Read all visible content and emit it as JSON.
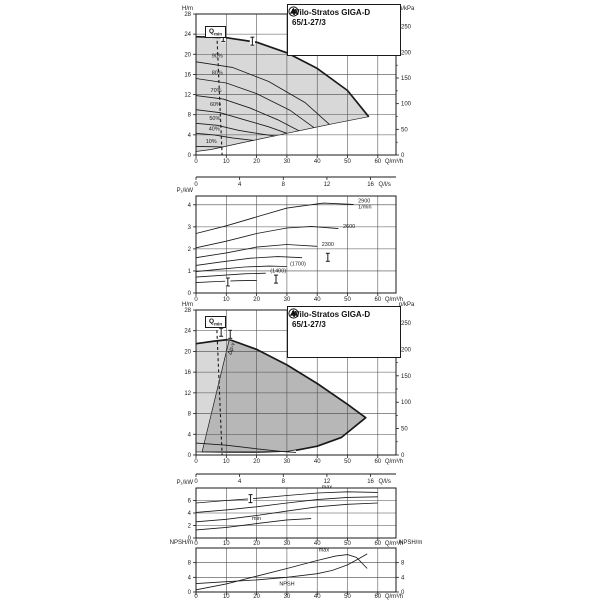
{
  "title_box": {
    "line1": "Wilo-Stratos GIGA-D",
    "line2": "65/1-27/3"
  },
  "qmin": {
    "main": "Q",
    "sub": "min"
  },
  "chart_data": [
    {
      "id": "c1",
      "type": "area",
      "title": "Wilo-Stratos GIGA-D 65/1-27/3 pump curves (speed control range)",
      "x_axis": {
        "label": "Q/m³/h",
        "min": 0,
        "max": 66,
        "ticks": [
          0,
          10,
          20,
          30,
          40,
          50,
          60
        ]
      },
      "x_axis2": {
        "label": "Q/l/s",
        "ticks": [
          0,
          4,
          8,
          12,
          16
        ],
        "factor": 3.6
      },
      "y_axis": {
        "label": "H/m",
        "min": 0,
        "max": 28,
        "ticks": [
          0,
          4,
          8,
          12,
          16,
          20,
          24,
          28
        ]
      },
      "y_axis_right": {
        "label": "p/kPa",
        "ticks": [
          0,
          50,
          100,
          150,
          200,
          250
        ],
        "per_m": 9.81
      },
      "regions": [
        {
          "name": "duty-range",
          "fill": "#d8d8d8",
          "pts": [
            [
              0,
              23.5
            ],
            [
              10,
              23.3
            ],
            [
              20,
              22.4
            ],
            [
              30,
              20.3
            ],
            [
              40,
              17.2
            ],
            [
              50,
              12.8
            ],
            [
              57,
              7.6
            ],
            [
              45,
              6.2
            ],
            [
              30,
              4.3
            ],
            [
              15,
              2.4
            ],
            [
              5,
              1.1
            ],
            [
              0,
              0.7
            ]
          ]
        }
      ],
      "edges": [
        {
          "name": "max-speed-curve",
          "pts": [
            [
              0,
              23.5
            ],
            [
              10,
              23.3
            ],
            [
              20,
              22.4
            ],
            [
              30,
              20.3
            ],
            [
              40,
              17.2
            ],
            [
              50,
              12.8
            ],
            [
              57,
              7.6
            ]
          ]
        }
      ],
      "curves": [
        {
          "label": "90%",
          "lx": 5.2,
          "ly": 19.4,
          "pts": [
            [
              0,
              18.5
            ],
            [
              12,
              17.4
            ],
            [
              24,
              14.6
            ],
            [
              36,
              10.4
            ],
            [
              44,
              6.1
            ]
          ]
        },
        {
          "label": "80%",
          "lx": 5.2,
          "ly": 16.0,
          "pts": [
            [
              0,
              15.2
            ],
            [
              10,
              14.3
            ],
            [
              20,
              12.2
            ],
            [
              31,
              8.9
            ],
            [
              39,
              5.4
            ]
          ]
        },
        {
          "label": "70%",
          "lx": 4.8,
          "ly": 12.5,
          "pts": [
            [
              0,
              11.8
            ],
            [
              9,
              11.1
            ],
            [
              18,
              9.3
            ],
            [
              27,
              7.0
            ],
            [
              34,
              4.8
            ]
          ]
        },
        {
          "label": "60%",
          "lx": 4.6,
          "ly": 9.7,
          "pts": [
            [
              0,
              9.0
            ],
            [
              8,
              8.4
            ],
            [
              16,
              7.0
            ],
            [
              24,
              5.6
            ],
            [
              30,
              4.3
            ]
          ]
        },
        {
          "label": "50%",
          "lx": 4.4,
          "ly": 7.0,
          "pts": [
            [
              0,
              6.3
            ],
            [
              7,
              5.9
            ],
            [
              14,
              4.9
            ],
            [
              21,
              4.2
            ],
            [
              26,
              3.8
            ]
          ]
        },
        {
          "label": "40%",
          "lx": 4.2,
          "ly": 4.9,
          "pts": [
            [
              0,
              4.3
            ],
            [
              6,
              4.0
            ],
            [
              12,
              3.4
            ],
            [
              19,
              2.9
            ]
          ]
        },
        {
          "label": "10%",
          "lx": 3.2,
          "ly": 2.4,
          "pts": [
            [
              0,
              1.7
            ],
            [
              5,
              1.65
            ],
            [
              9,
              1.6
            ]
          ]
        }
      ],
      "dashed": [
        {
          "name": "qmin-line",
          "pts": [
            [
              6.9,
              23.8
            ],
            [
              8.6,
              0
            ]
          ]
        }
      ],
      "markers": [
        [
          9,
          23.35
        ],
        [
          18.6,
          22.6
        ]
      ],
      "labels": []
    },
    {
      "id": "c2",
      "type": "line",
      "title": "Power input P1 vs Q at constant speeds",
      "x_axis": {
        "label": "Q/m³/h",
        "min": 0,
        "max": 66,
        "ticks": [
          0,
          10,
          20,
          30,
          40,
          50,
          60
        ]
      },
      "y_axis": {
        "label": "P₁/kW",
        "min": 0,
        "max": 4.4,
        "ticks": [
          0,
          1,
          2,
          3,
          4
        ]
      },
      "regions": [],
      "edges": [],
      "curves": [
        {
          "label": "2900",
          "label2": "1/min",
          "lx": 53.5,
          "ly": 4.1,
          "pts": [
            [
              0,
              2.7
            ],
            [
              10,
              3.05
            ],
            [
              20,
              3.45
            ],
            [
              30,
              3.85
            ],
            [
              42,
              4.08
            ],
            [
              52,
              4.02
            ]
          ]
        },
        {
          "label": "2600",
          "lx": 48.5,
          "ly": 2.95,
          "pts": [
            [
              0,
              2.05
            ],
            [
              10,
              2.35
            ],
            [
              20,
              2.7
            ],
            [
              30,
              2.95
            ],
            [
              38,
              3.02
            ],
            [
              47,
              2.92
            ]
          ]
        },
        {
          "label": "2300",
          "lx": 41.5,
          "ly": 2.14,
          "pts": [
            [
              0,
              1.6
            ],
            [
              10,
              1.82
            ],
            [
              20,
              2.08
            ],
            [
              30,
              2.2
            ],
            [
              40,
              2.12
            ]
          ]
        },
        {
          "label": "",
          "pts": [
            [
              0,
              1.25
            ],
            [
              8,
              1.4
            ],
            [
              18,
              1.58
            ],
            [
              27,
              1.65
            ],
            [
              35,
              1.6
            ]
          ]
        },
        {
          "label": "(1700)",
          "lx": 31,
          "ly": 1.24,
          "pts": [
            [
              0,
              0.97
            ],
            [
              8,
              1.08
            ],
            [
              16,
              1.18
            ],
            [
              24,
              1.22
            ],
            [
              30,
              1.2
            ]
          ]
        },
        {
          "label": "(1400)",
          "lx": 24.5,
          "ly": 0.93,
          "pts": [
            [
              0,
              0.72
            ],
            [
              8,
              0.8
            ],
            [
              16,
              0.87
            ],
            [
              23,
              0.9
            ]
          ]
        },
        {
          "label": "",
          "pts": [
            [
              0,
              0.47
            ],
            [
              7,
              0.52
            ],
            [
              14,
              0.56
            ],
            [
              20,
              0.57
            ]
          ]
        }
      ],
      "dashed": [],
      "markers": [
        [
          43.5,
          1.62
        ],
        [
          26.4,
          0.63
        ],
        [
          10.5,
          0.5
        ]
      ],
      "labels": []
    },
    {
      "id": "c3",
      "type": "area",
      "title": "Wilo-Stratos GIGA-D 65/1-27/3 control range Δp-v",
      "x_axis": {
        "label": "Q/m³/h",
        "min": 0,
        "max": 66,
        "ticks": [
          0,
          10,
          20,
          30,
          40,
          50,
          60
        ]
      },
      "x_axis2": {
        "label": "Q/l/s",
        "ticks": [
          0,
          4,
          8,
          12,
          16
        ],
        "factor": 3.6
      },
      "y_axis": {
        "label": "H/m",
        "min": 0,
        "max": 28,
        "ticks": [
          0,
          4,
          8,
          12,
          16,
          20,
          24,
          28
        ]
      },
      "y_axis_right": {
        "label": "p/kPa",
        "ticks": [
          0,
          50,
          100,
          150,
          200,
          250
        ],
        "per_m": 9.81
      },
      "regions": [
        {
          "name": "full-duty-range",
          "fill": "#d8d8d8",
          "pts": [
            [
              0,
              21.5
            ],
            [
              6,
              22.0
            ],
            [
              11,
              22.3
            ],
            [
              20,
              20.4
            ],
            [
              30,
              17.4
            ],
            [
              40,
              13.8
            ],
            [
              50,
              9.8
            ],
            [
              56,
              7.2
            ],
            [
              48,
              3.4
            ],
            [
              40,
              1.7
            ],
            [
              30,
              0.7
            ],
            [
              20,
              0.45
            ],
            [
              10,
              0.5
            ],
            [
              0,
              0.6
            ]
          ]
        },
        {
          "name": "dp-v-control-range",
          "fill": "#b7b7b7",
          "pts": [
            [
              2,
              0.6
            ],
            [
              11,
              22.3
            ],
            [
              20,
              20.4
            ],
            [
              30,
              17.4
            ],
            [
              40,
              13.8
            ],
            [
              50,
              9.8
            ],
            [
              56,
              7.2
            ],
            [
              48,
              3.4
            ],
            [
              40,
              1.7
            ],
            [
              30,
              0.7
            ],
            [
              20,
              0.6
            ],
            [
              10,
              0.6
            ]
          ]
        }
      ],
      "edges": [
        {
          "name": "max-speed-curve",
          "pts": [
            [
              0,
              21.5
            ],
            [
              6,
              22.0
            ],
            [
              11,
              22.3
            ],
            [
              20,
              20.4
            ],
            [
              30,
              17.4
            ],
            [
              40,
              13.8
            ],
            [
              50,
              9.8
            ],
            [
              56,
              7.2
            ],
            [
              48,
              3.4
            ],
            [
              40,
              1.7
            ],
            [
              33,
              0.9
            ]
          ]
        }
      ],
      "curves": [
        {
          "label": "",
          "pts": [
            [
              0,
              2.3
            ],
            [
              10,
              1.9
            ],
            [
              20,
              1.2
            ],
            [
              28,
              0.7
            ],
            [
              33,
              0.5
            ]
          ]
        }
      ],
      "dashed": [
        {
          "name": "qmin-line",
          "pts": [
            [
              6.9,
              24.1
            ],
            [
              8.6,
              0
            ]
          ]
        }
      ],
      "markers": [
        [
          8.3,
          23.7
        ],
        [
          11.3,
          23.3
        ]
      ],
      "labels": [
        {
          "text": "Δp-v",
          "q": 11.6,
          "v": 19.3,
          "rot": -72
        }
      ]
    },
    {
      "id": "c4",
      "type": "line",
      "title": "Power input P1 control range min/max",
      "x_axis": {
        "label": "Q/m³/h",
        "min": 0,
        "max": 66,
        "ticks": [
          0,
          10,
          20,
          30,
          40,
          50,
          60
        ]
      },
      "y_axis": {
        "label": "P₁/kW",
        "min": 0,
        "max": 8,
        "ticks": [
          0,
          2,
          4,
          6
        ]
      },
      "regions": [],
      "edges": [],
      "curves": [
        {
          "label": "max",
          "lx": 41.5,
          "ly": 7.9,
          "pts": [
            [
              0,
              5.6
            ],
            [
              10,
              6.0
            ],
            [
              20,
              6.35
            ],
            [
              30,
              6.8
            ],
            [
              40,
              7.2
            ],
            [
              50,
              7.4
            ],
            [
              60,
              7.3
            ]
          ]
        },
        {
          "label": "",
          "pts": [
            [
              0,
              4.1
            ],
            [
              10,
              4.5
            ],
            [
              20,
              5.0
            ],
            [
              30,
              5.6
            ],
            [
              40,
              6.15
            ],
            [
              50,
              6.5
            ],
            [
              60,
              6.6
            ]
          ]
        },
        {
          "label": "",
          "pts": [
            [
              0,
              2.6
            ],
            [
              10,
              3.0
            ],
            [
              20,
              3.6
            ],
            [
              30,
              4.3
            ],
            [
              40,
              5.0
            ],
            [
              50,
              5.4
            ],
            [
              60,
              5.6
            ]
          ]
        },
        {
          "label": "min",
          "lx": 18.5,
          "ly": 2.9,
          "pts": [
            [
              0,
              1.3
            ],
            [
              10,
              1.7
            ],
            [
              20,
              2.3
            ],
            [
              30,
              2.9
            ],
            [
              38,
              3.1
            ]
          ]
        }
      ],
      "dashed": [],
      "markers": [
        [
          18,
          6.3
        ]
      ],
      "labels": []
    },
    {
      "id": "c5",
      "type": "line",
      "title": "NPSH vs Q",
      "x_axis": {
        "label": "Q/m³/h",
        "min": 0,
        "max": 66,
        "ticks": [
          0,
          10,
          20,
          30,
          40,
          50,
          60
        ]
      },
      "y_axis": {
        "label": "NPSH/m",
        "min": 0,
        "max": 12,
        "ticks": [
          0,
          4,
          8
        ]
      },
      "y_axis_right": {
        "label": "NPSH/m",
        "ticks": [
          0,
          4,
          8
        ],
        "per_m": 1
      },
      "regions": [],
      "edges": [],
      "curves": [
        {
          "label": "max",
          "lx": 40.5,
          "ly": 11.0,
          "pts": [
            [
              0,
              0.6
            ],
            [
              10,
              2.2
            ],
            [
              20,
              4.3
            ],
            [
              30,
              6.4
            ],
            [
              40,
              8.6
            ],
            [
              46,
              9.8
            ],
            [
              50,
              10.2
            ],
            [
              53,
              9.4
            ],
            [
              56.5,
              6.4
            ]
          ]
        },
        {
          "label": "NPSH",
          "lx": 27.5,
          "ly": 1.8,
          "pts": [
            [
              0,
              2.3
            ],
            [
              10,
              2.8
            ],
            [
              20,
              3.3
            ],
            [
              30,
              4.0
            ],
            [
              40,
              5.0
            ],
            [
              45,
              5.9
            ],
            [
              50,
              7.4
            ],
            [
              54,
              9.2
            ],
            [
              56.5,
              10.4
            ]
          ]
        }
      ],
      "dashed": [],
      "markers": [],
      "labels": []
    }
  ]
}
